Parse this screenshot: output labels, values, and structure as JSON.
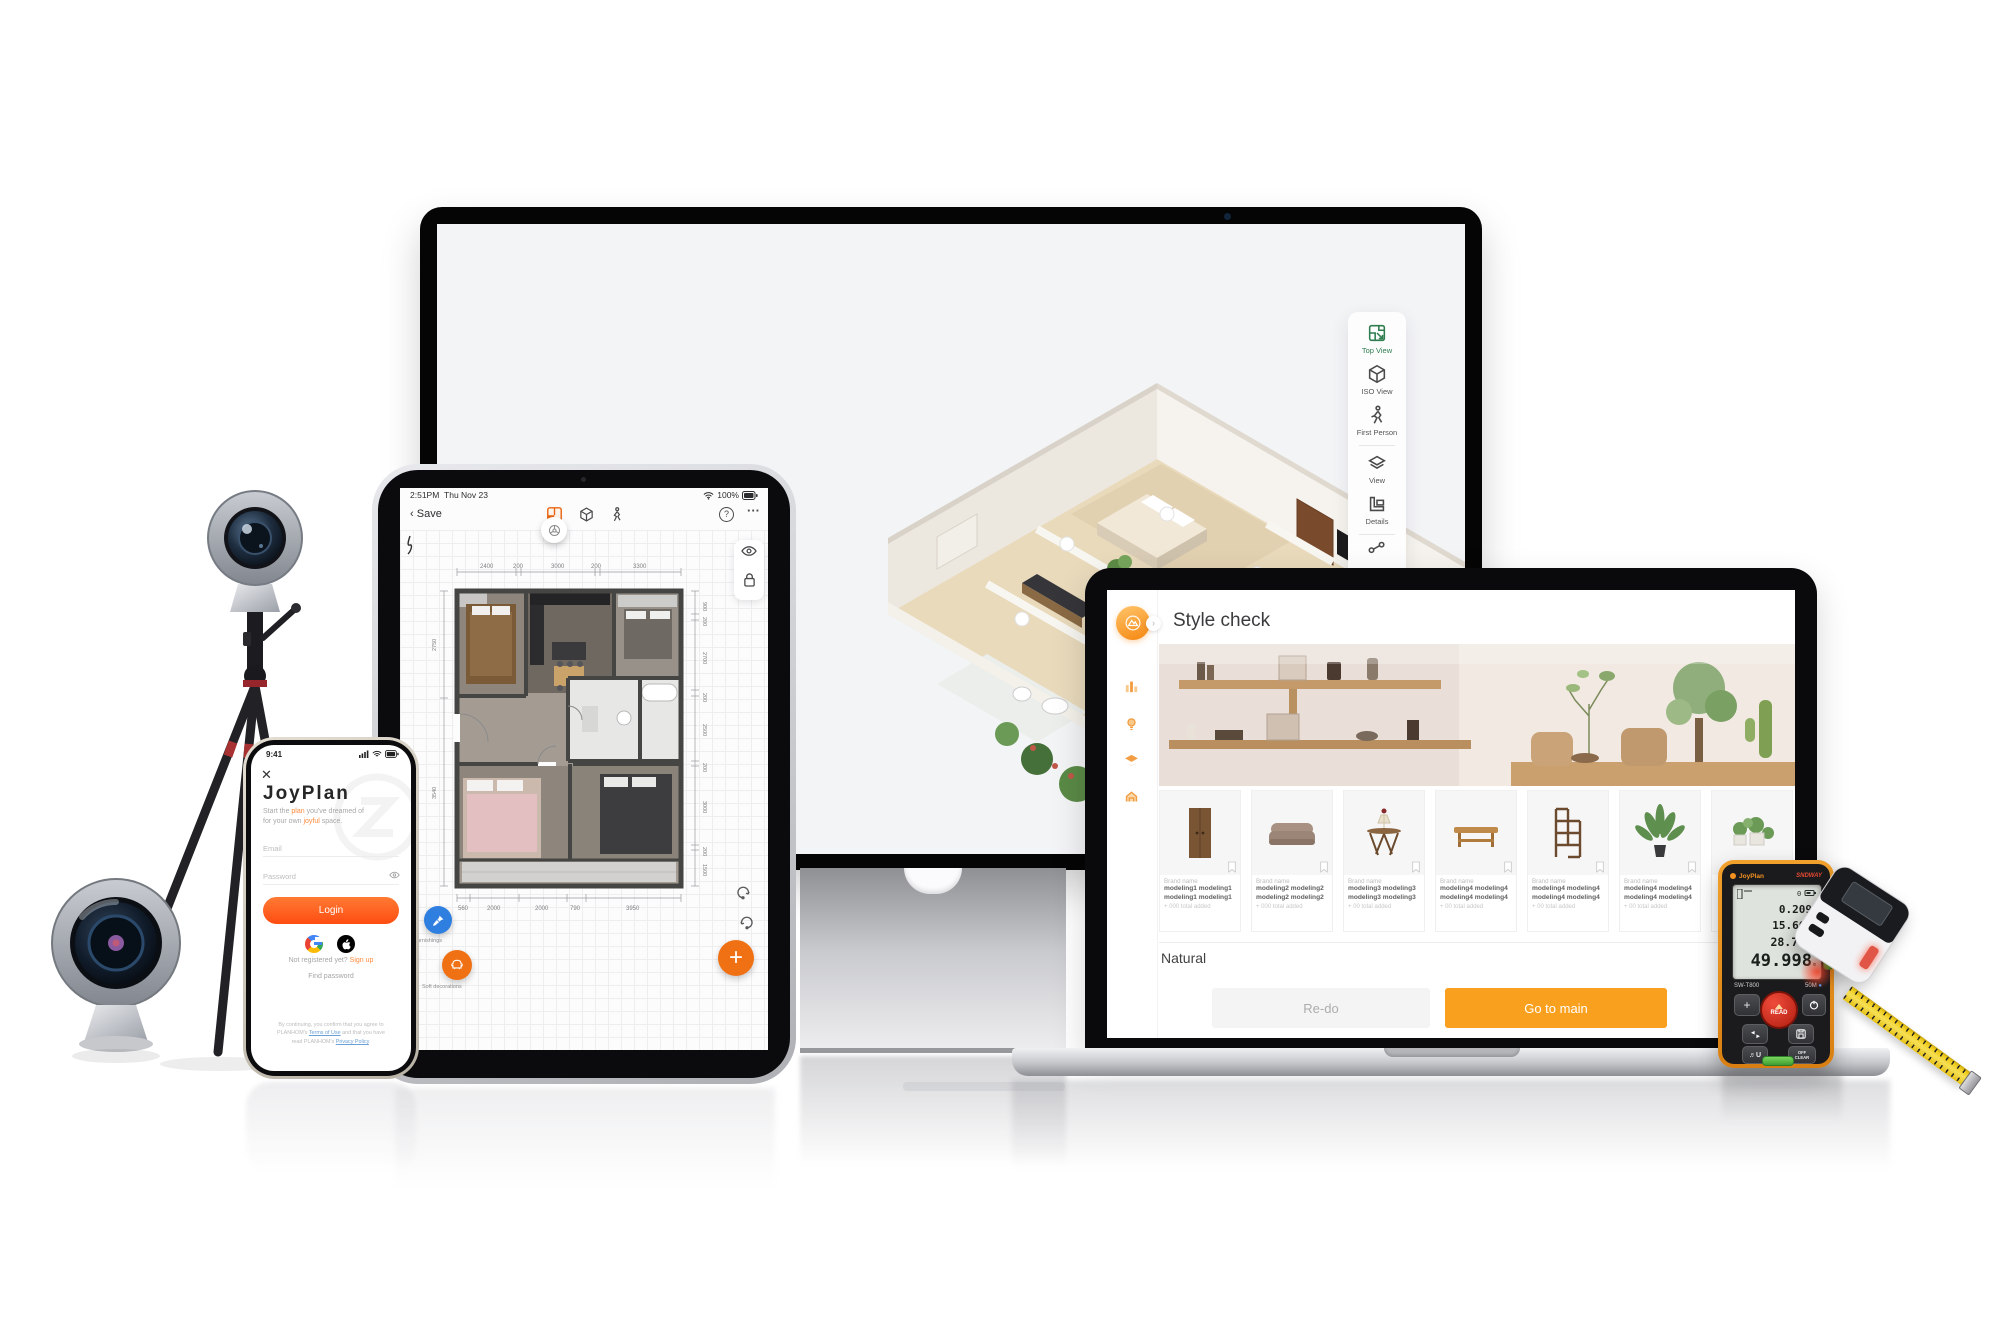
{
  "colors": {
    "accent_orange": "#F8961D",
    "deep_orange": "#FF5A1F",
    "active_green": "#2E7D4E",
    "link_blue": "#6AA1D8",
    "level_green": "#58B84A"
  },
  "monitor": {
    "view_toolbar": {
      "items": [
        {
          "label": "Top View",
          "active": true
        },
        {
          "label": "ISO View",
          "active": false
        },
        {
          "label": "First Person",
          "active": false
        },
        {
          "label": "View",
          "active": false
        },
        {
          "label": "Details",
          "active": false
        }
      ]
    }
  },
  "tablet": {
    "status": {
      "time": "2:51PM",
      "date": "Thu Nov 23",
      "battery": "100%"
    },
    "toolbar": {
      "back_label": "Save",
      "help": "?",
      "more": "···"
    },
    "canvas_fabs": {
      "hard": "Hard furnishings",
      "soft": "Soft decorations"
    },
    "plan": {
      "dims_top": [
        "2400",
        "200",
        "3000",
        "200",
        "3300"
      ],
      "dims_bottom": [
        "560",
        "2000",
        "2000",
        "790",
        "3950"
      ],
      "dims_right": [
        "900",
        "200",
        "2700",
        "200",
        "2500",
        "200",
        "3000",
        "200",
        "1500"
      ],
      "dims_left": [
        "2750",
        "3540"
      ]
    }
  },
  "phone": {
    "status_time": "9:41",
    "title": "JoyPlan",
    "subtitle": {
      "a1": "Start the ",
      "a2": "plan",
      "a3": " you've dreamed of",
      "b1": "for your own ",
      "b2": "joyful",
      "b3": " space."
    },
    "email_placeholder": "Email",
    "password_placeholder": "Password",
    "login_label": "Login",
    "not_registered": "Not registered yet?",
    "sign_up": "Sign up",
    "find_password": "Find password",
    "legal": {
      "l1": "By continuing, you confirm that you agree to",
      "l2a": "PLANHOM's ",
      "l2b": "Terms of Use",
      "l2c": " and that you have",
      "l3a": "read PLANHOM's ",
      "l3b": "Privacy Policy",
      "l3c": "."
    }
  },
  "laptop": {
    "title": "Style check",
    "section_title": "Natural",
    "redo_label": "Re-do",
    "go_label": "Go to main",
    "cards": [
      {
        "brand": "Brand name",
        "line1": "modeling1 modeling1",
        "line2": "modeling1 modeling1",
        "added": "+ 000 total added"
      },
      {
        "brand": "Brand name",
        "line1": "modeling2 modeling2",
        "line2": "modeling2 modeling2",
        "added": "+ 000 total added"
      },
      {
        "brand": "Brand name",
        "line1": "modeling3 modeling3",
        "line2": "modeling3 modeling3",
        "added": "+ 00 total added"
      },
      {
        "brand": "Brand name",
        "line1": "modeling4 modeling4",
        "line2": "modeling4 modeling4",
        "added": "+ 00 total added"
      },
      {
        "brand": "Brand name",
        "line1": "modeling4 modeling4",
        "line2": "modeling4 modeling4",
        "added": "+ 00 total added"
      },
      {
        "brand": "Brand name",
        "line1": "modeling4 modeling4",
        "line2": "modeling4 modeling4",
        "added": "+ 00 total added"
      }
    ]
  },
  "measurer": {
    "brand": "JoyPlan",
    "brand2": "SNDWAY",
    "lcd": {
      "r1": "0.209",
      "r2": "15.663",
      "r3": "28.776",
      "big": "49.998",
      "unit": "m"
    },
    "model": "SW-T800",
    "range": "50M",
    "buttons": {
      "plus": "+",
      "read": "READ",
      "u": "U",
      "off": "OFF",
      "clear": "CLEAR"
    }
  }
}
